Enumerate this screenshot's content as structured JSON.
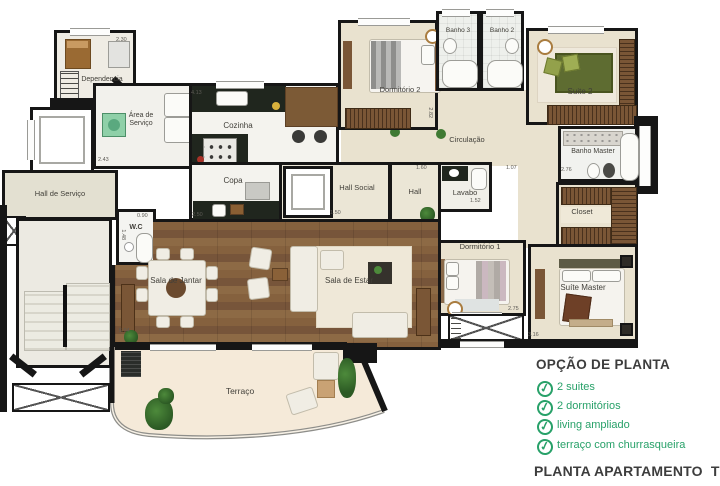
{
  "plan": {
    "rooms": {
      "dependencia": "Dependencia",
      "area_servico": "Área de Serviço",
      "cozinha": "Cozinha",
      "copa": "Copa",
      "wc": "W.C",
      "hall_servico": "Hall de Serviço",
      "hall_social": "Hall Social",
      "hall": "Hall",
      "lavabo": "Lavabo",
      "circulacao": "Circulação",
      "banho3": "Banho 3",
      "banho2": "Banho 2",
      "dormitorio2": "Dormitório 2",
      "suite2": "Suite 2",
      "banho_master": "Banho Master",
      "closet": "Closet",
      "dormitorio1": "Dormitório 1",
      "suite_master": "Suíte Master",
      "sala_jantar": "Sala de Jantar",
      "sala_estar": "Sala de Estar",
      "terraco": "Terraço"
    },
    "dims": [
      "2.30",
      "4.13",
      "2.43",
      "2.50",
      "0.90",
      "1.48",
      "1.50",
      "1.60",
      "1.07",
      "1.52",
      "2.82",
      "2.76",
      "2.75",
      "3.16",
      "5.04"
    ],
    "colors": {
      "wall": "#161616",
      "floor_cream": "#e9e2cf",
      "floor_wood": "#805d3c",
      "floor_terrace": "#f5ead9",
      "counter_dark": "#20261e",
      "wardrobe_wood": "#7a5636",
      "accent_green": "#28a169",
      "heading_text": "#3d3d3d"
    }
  },
  "options": {
    "title": "OPÇÃO DE PLANTA",
    "check_icon": "✓",
    "features": [
      "2 suites",
      "2 dormitórios",
      "living ampliado",
      "terraço com churrasqueira"
    ],
    "footer": "PLANTA APARTAMENTO  TIPO C"
  }
}
